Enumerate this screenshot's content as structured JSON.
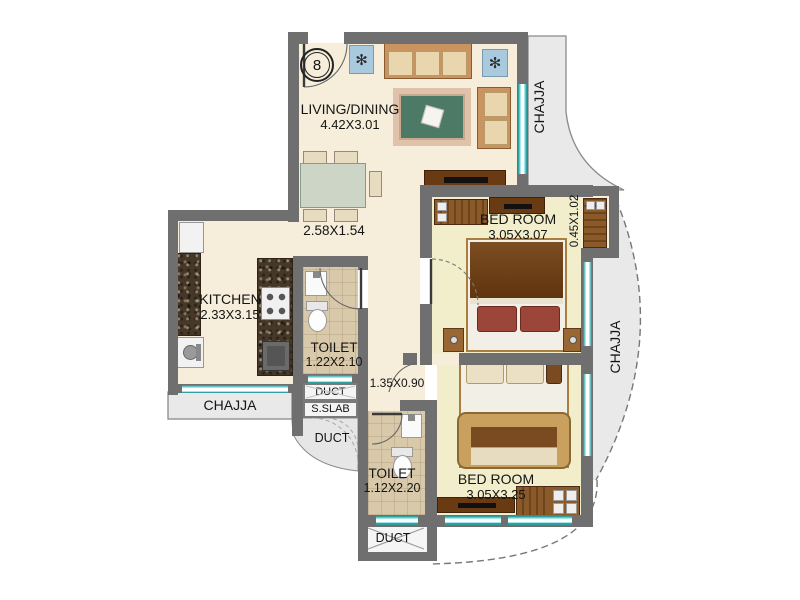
{
  "unit": {
    "number": "8"
  },
  "rooms": {
    "living": {
      "name": "LIVING/DINING",
      "dims": "4.42X3.01"
    },
    "dining": {
      "dims": "2.58X1.54"
    },
    "bedroom_top": {
      "name": "BED ROOM",
      "dims": "3.05X3.07"
    },
    "bedroom_bottom": {
      "name": "BED ROOM",
      "dims": "3.05X3.25"
    },
    "kitchen": {
      "name": "KITCHEN",
      "dims": "2.33X3.15"
    },
    "toilet_top": {
      "name": "TOILET",
      "dims": "1.22X2.10"
    },
    "toilet_bottom": {
      "name": "TOILET",
      "dims": "1.12X2.20"
    },
    "passage": {
      "dims": "1.35X0.90"
    },
    "niche": {
      "dims": "0.45X1.02"
    }
  },
  "annotations": {
    "chajja_top_right": "CHAJJA",
    "chajja_mid_right": "CHAJJA",
    "chajja_bottom_left": "CHAJJA",
    "duct_upper": "DUCT",
    "s_slab": "S.SLAB",
    "duct_curved": "DUCT",
    "duct_bottom": "DUCT"
  },
  "icons": {
    "plant": "✻"
  },
  "colors": {
    "wall": "#6f6f6f",
    "floor_main": "#f6eedb",
    "floor_bedroom": "#f2eecb",
    "floor_toilet": "#d9c9ab",
    "chajja": "#e9e9e9",
    "window": "#7fd8d8",
    "furniture_brown": "#8a5a2a",
    "furniture_dark": "#6a3a12",
    "text": "#141414"
  }
}
